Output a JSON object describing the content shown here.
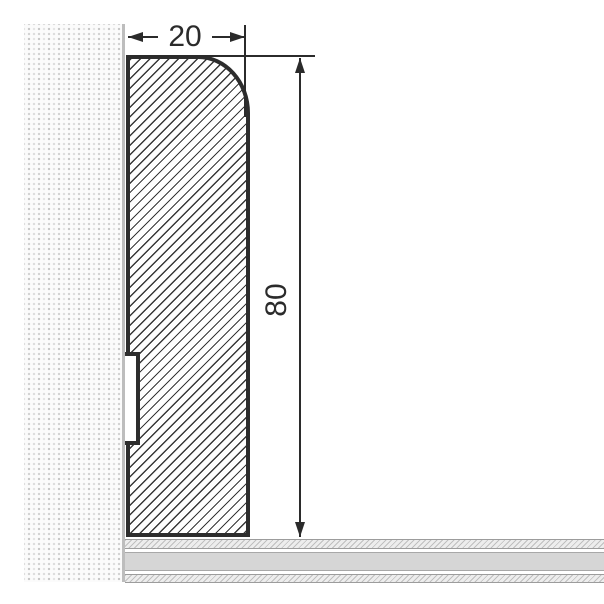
{
  "drawing": {
    "description": "skirting-board-cross-section",
    "dimensions": {
      "width": {
        "label": "20"
      },
      "height": {
        "label": "80"
      }
    },
    "colors": {
      "outline": "#2d2d2d",
      "dimension_line": "#2b2b2b",
      "wall_edge": "#bdbdbd",
      "floor_solid": "#d6d6d6",
      "floor_hatch": "#bfbfbf",
      "background": "#ffffff"
    }
  }
}
